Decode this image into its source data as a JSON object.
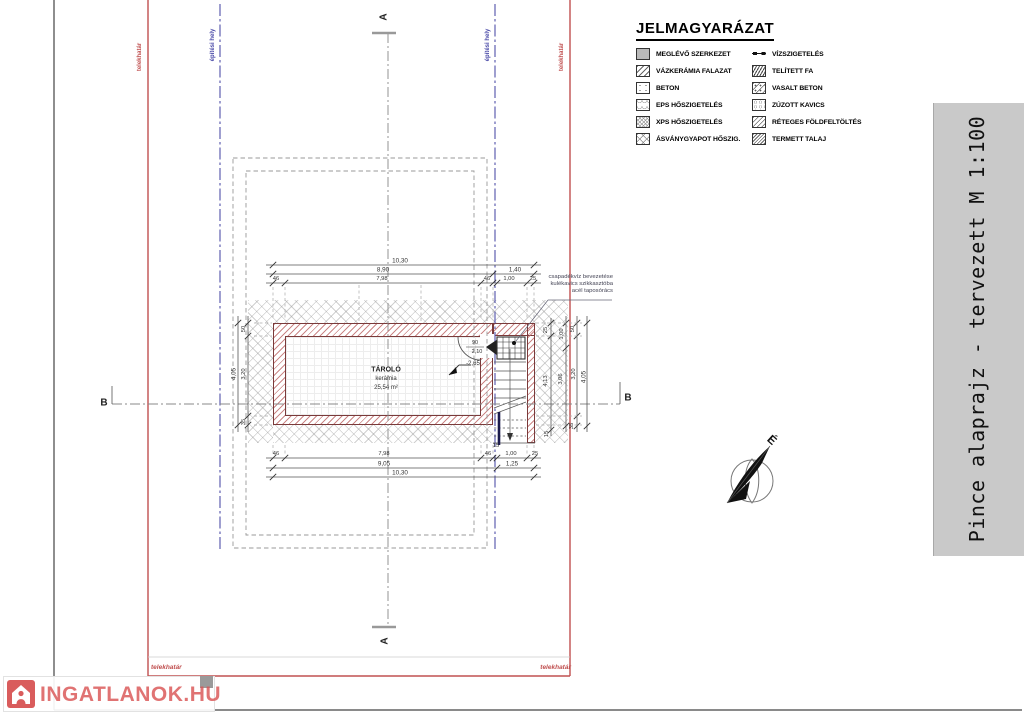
{
  "title_block": {
    "text": "Pince alaprajz - tervezett M 1:100"
  },
  "legend": {
    "title": "JELMAGYARÁZAT",
    "left": [
      {
        "label": "MEGLÉVŐ SZERKEZET",
        "pattern": "solid-gray"
      },
      {
        "label": "VÁZKERÁMIA FALAZAT",
        "pattern": "diagonal-hatch"
      },
      {
        "label": "BETON",
        "pattern": "concrete-dots"
      },
      {
        "label": "EPS HŐSZIGETELÉS",
        "pattern": "eps-loops"
      },
      {
        "label": "XPS HŐSZIGETELÉS",
        "pattern": "xps-grid"
      },
      {
        "label": "ÁSVÁNYGYAPOT HŐSZIG.",
        "pattern": "cross-hatch"
      }
    ],
    "right": [
      {
        "label": "VÍZSZIGETELÉS",
        "pattern": "waterproof-line-symbol"
      },
      {
        "label": "TELÍTETT FA",
        "pattern": "dense-wood-hatch"
      },
      {
        "label": "VASALT BETON",
        "pattern": "hatch-with-dots"
      },
      {
        "label": "ZÚZOTT KAVICS",
        "pattern": "gravel"
      },
      {
        "label": "RÉTEGES FÖLDFELTÖLTÉS",
        "pattern": "layered-fill-hatch"
      },
      {
        "label": "TERMETT TALAJ",
        "pattern": "soil-hatch"
      }
    ]
  },
  "boundary": {
    "property_label": "telekhatár",
    "building_zone_label": "építési hely"
  },
  "sections": {
    "a": "A",
    "b": "B"
  },
  "room": {
    "name": "TÁROLÓ",
    "finish": "kerámia",
    "area": "25,54 m²",
    "level": "-2,65"
  },
  "door": {
    "width": "90",
    "height": "2,10"
  },
  "note": {
    "line1": "csapadékvíz bevezetése",
    "line2": "kulékavics szikkasztóba",
    "line3": "acél taposórács"
  },
  "compass": {
    "north": "É"
  },
  "watermark": {
    "text": "INGATLANOK.HU"
  },
  "dims": {
    "top": {
      "total": "10,30",
      "a": "8,90",
      "b": "1,40",
      "c": "46",
      "d": "7,98",
      "e": "46",
      "f": "1,00",
      "g": "25"
    },
    "bottom": {
      "a": "46",
      "b": "7,98",
      "c": "46",
      "d15": "15",
      "d": "1,00",
      "e": "25",
      "f": "9,05",
      "g": "1,25",
      "total": "10,30"
    },
    "left": {
      "total": "4,05",
      "a": "50",
      "b": "3,20",
      "c": "35"
    },
    "right": {
      "a": "1,00",
      "b": "3,06",
      "c": "50",
      "d": "3,20",
      "e": "35",
      "total": "4,05",
      "stair": "4,13",
      "f": "25",
      "g": "15"
    }
  },
  "colors": {
    "boundary_red": "#c05050",
    "building_zone_blue": "#5050a8",
    "wall_brown": "#7a3a3a",
    "title_band_gray": "#c9c9c9",
    "watermark_red": "#d95454"
  }
}
